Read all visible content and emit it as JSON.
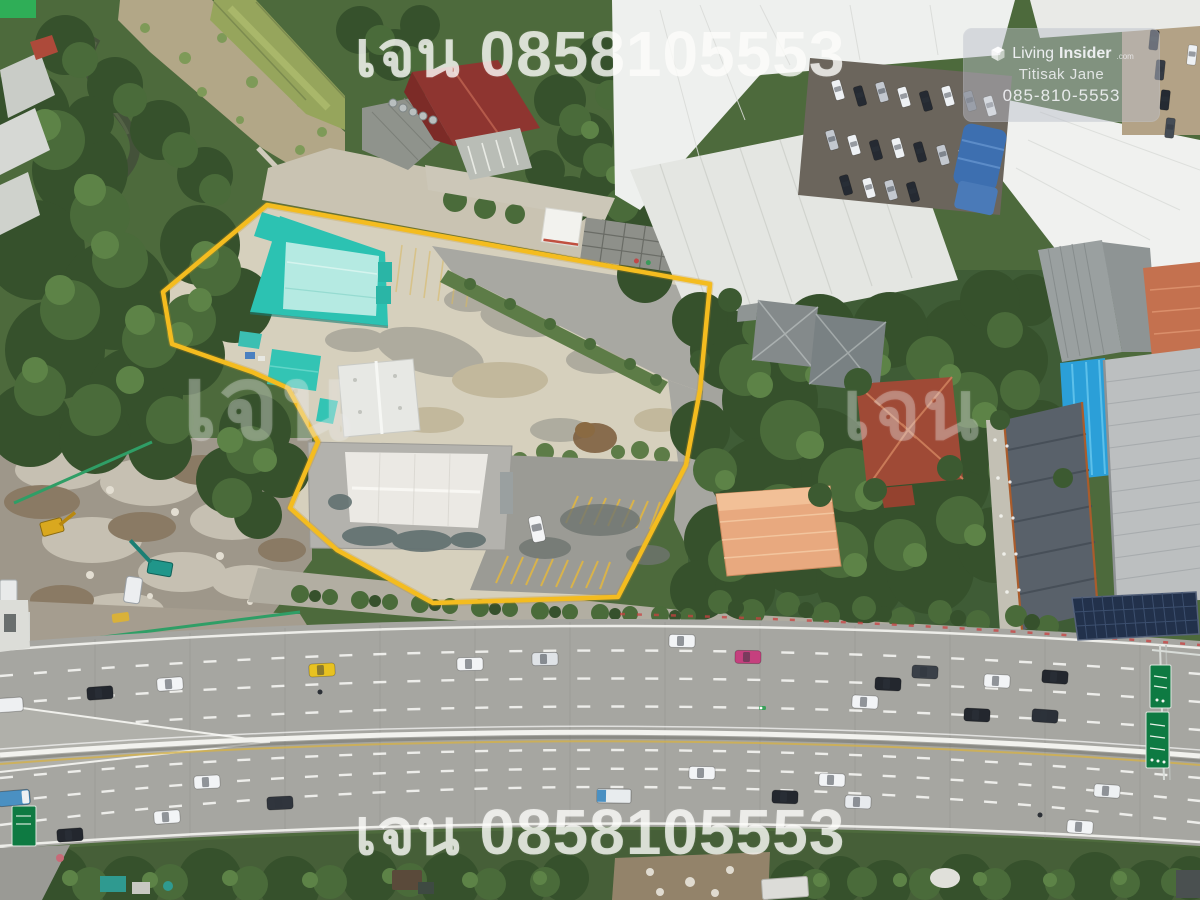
{
  "watermarks": {
    "top": "เจน 0858105553",
    "middle_left": "เจน",
    "middle_right": "เจน",
    "bottom": "เจน 0858105553"
  },
  "badge": {
    "brand_prefix": "Living",
    "brand_suffix": "Insider",
    "brand_tld": ".com",
    "agent_name": "Titisak Jane",
    "agent_phone": "085-810-5553"
  },
  "scene": {
    "description": "Aerial drone photo of a land plot outlined in yellow beside a multi-lane divided highway, surrounded by warehouses, houses and trees",
    "colors": {
      "boundary_line": "#f4bc1f",
      "teal_roof": "#2cc2b2",
      "teal_roof_panel": "#b5eae2",
      "concrete_yard": "#d6d0bd",
      "highway_asphalt": "#a6a6a1",
      "median_barrier": "#f2f2ee",
      "lane_marking": "#ffffff",
      "tree_canopy": "#3f5e34",
      "red_roof": "#9f4a36",
      "orange_roof": "#e8a97f",
      "blue_tarp": "#2b9fd8",
      "highway_sign_green": "#0e7a42",
      "taxi_yellow": "#e8c220",
      "taxi_pink": "#c5407e"
    }
  }
}
